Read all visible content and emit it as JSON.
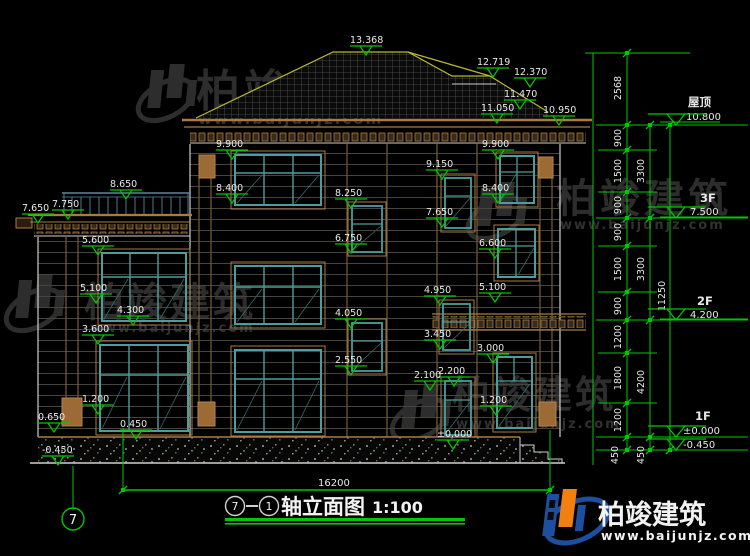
{
  "brand": {
    "name": "柏竣建筑",
    "url": "www.baijunjz.com"
  },
  "title": {
    "from": "7",
    "to": "1",
    "name": "轴立面图",
    "scale": "1:100"
  },
  "bottom": {
    "overall": "16200",
    "axis": "7"
  },
  "floors": {
    "roof_name": "屋顶",
    "roof_lv": "10.800",
    "f3_name": "3F",
    "f3_lv": "7.500",
    "f2_name": "2F",
    "f2_lv": "4.200",
    "f1_name": "1F",
    "f1_lv": "±0.000",
    "below_lv": "-0.450"
  },
  "chains": {
    "outer": [
      "2568",
      "900",
      "1500",
      "900",
      "900",
      "1500",
      "900",
      "1200",
      "1800",
      "1200",
      "450"
    ],
    "mid": [
      "3300",
      "3300",
      "4200",
      "450"
    ],
    "total": "11250"
  },
  "marks": {
    "roof": [
      "13.368",
      "12.719",
      "12.370",
      "11.470",
      "11.050",
      "10.950"
    ],
    "left": [
      "8.650",
      "7.750",
      "7.650",
      "5.600",
      "5.100",
      "4.300",
      "3.600",
      "1.200",
      "0.650",
      "0.450",
      "-0.450"
    ],
    "mid": [
      "9.900",
      "8.400",
      "8.250",
      "6.750",
      "4.050",
      "2.550"
    ],
    "stair": [
      "9.150",
      "7.650",
      "4.950",
      "3.450",
      "2.200",
      "2.100",
      "±0.000"
    ],
    "right": [
      "9.900",
      "8.400",
      "6.600",
      "5.100",
      "3.000",
      "1.200"
    ]
  }
}
